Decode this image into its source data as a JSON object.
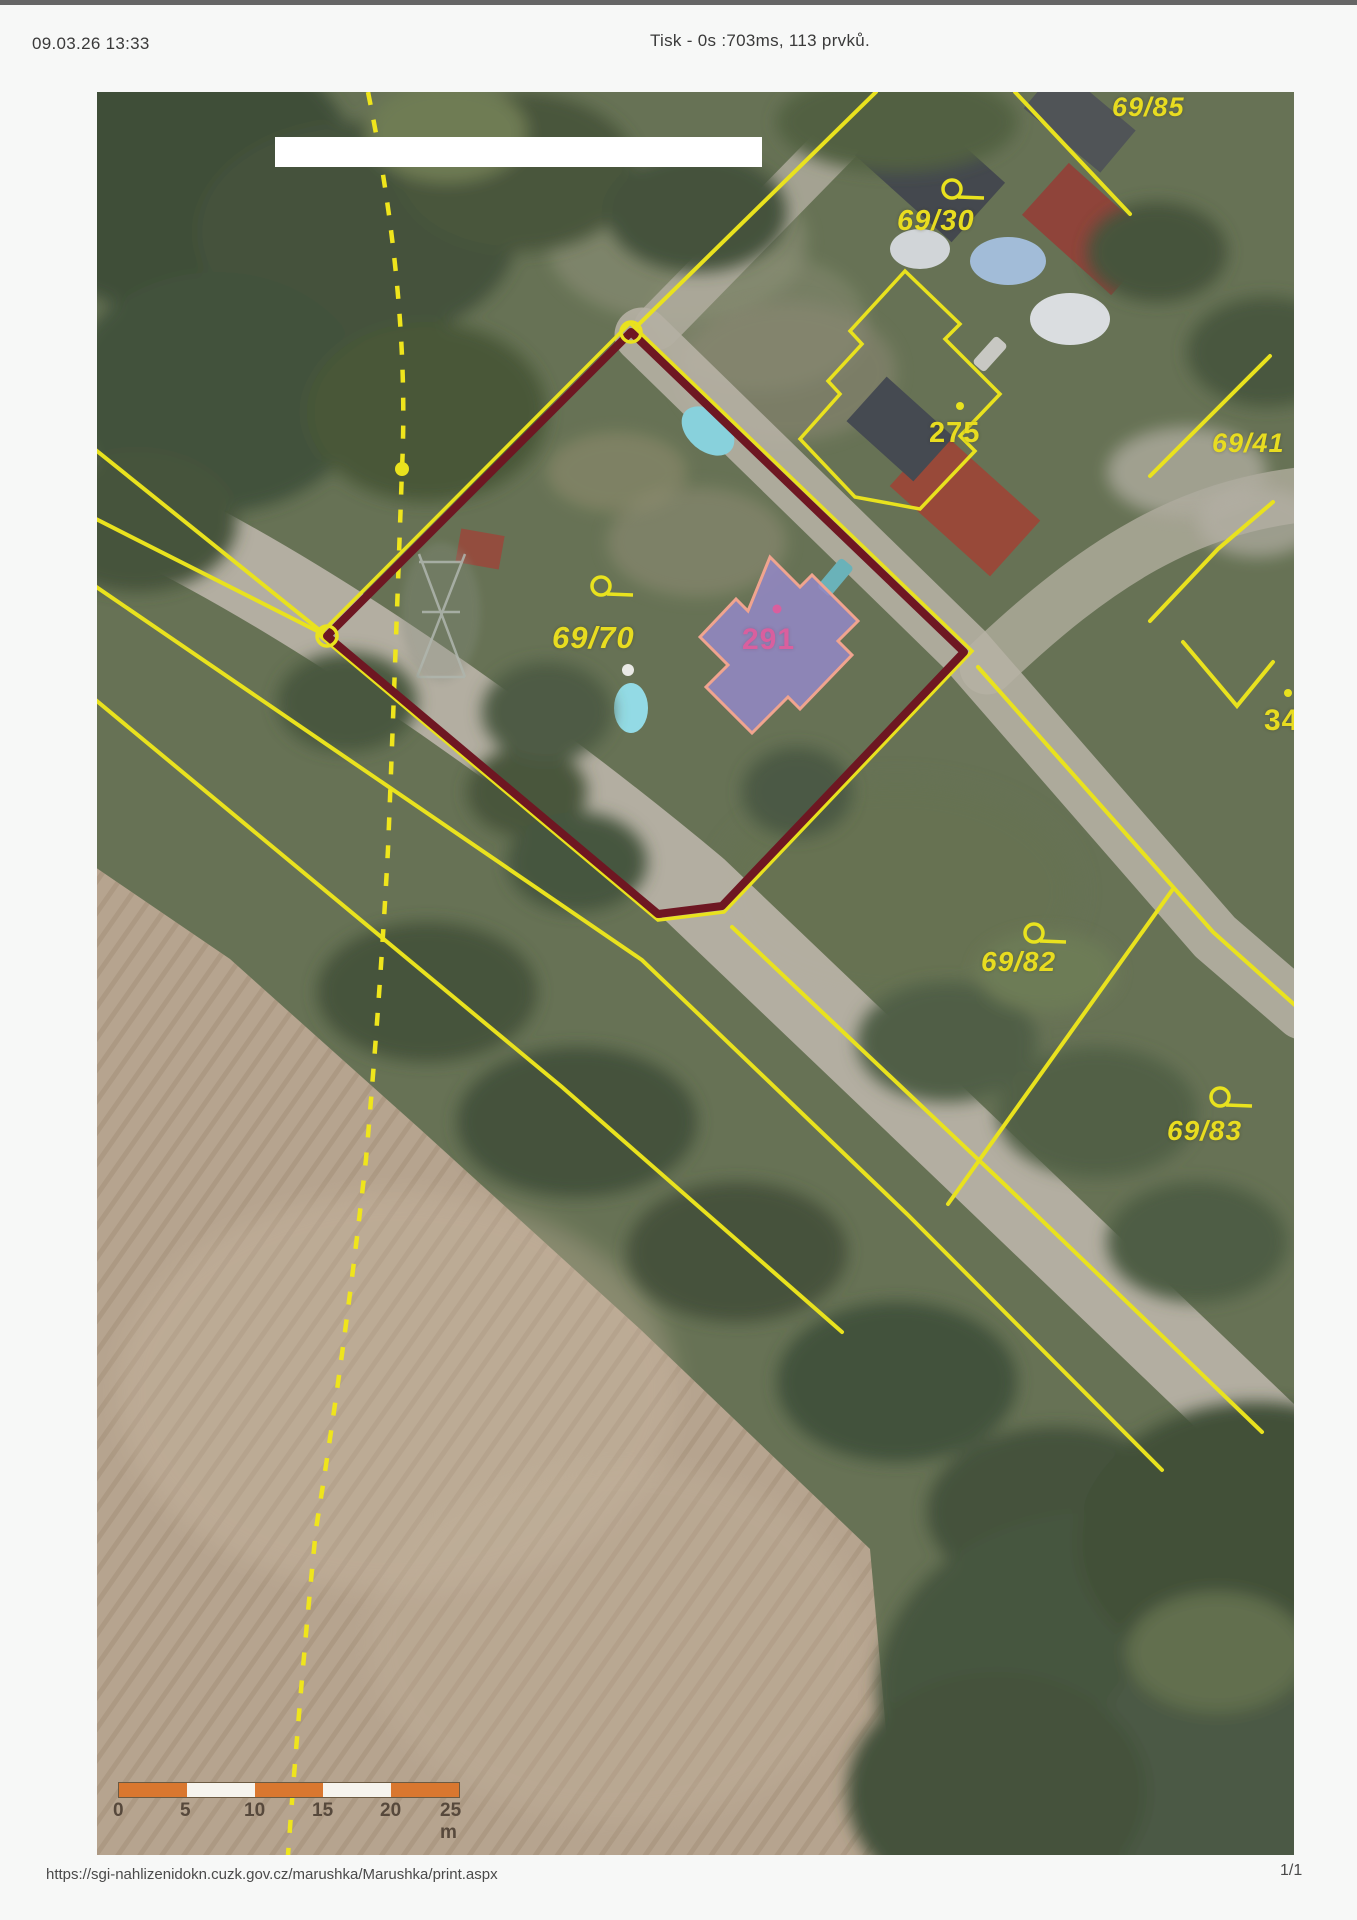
{
  "header": {
    "datetime": "09.03.26 13:33",
    "print_status": "Tisk - 0s :703ms, 113 prvků."
  },
  "footer": {
    "url": "https://sgi-nahlizenidokn.cuzk.gov.cz/marushka/Marushka/print.aspx",
    "page_indicator": "1/1"
  },
  "map": {
    "parcel_labels": [
      {
        "id": "69/85",
        "text": "69/85"
      },
      {
        "id": "69/30",
        "text": "69/30"
      },
      {
        "id": "69/41",
        "text": "69/41"
      },
      {
        "id": "69/70",
        "text": "69/70"
      },
      {
        "id": "69/82",
        "text": "69/82"
      },
      {
        "id": "69/83",
        "text": "69/83"
      }
    ],
    "building_labels": [
      {
        "id": "275",
        "text": "275"
      },
      {
        "id": "34",
        "text": "34"
      },
      {
        "id": "291",
        "text": "291"
      }
    ],
    "icons": {
      "parcel_point_marker": "circle-with-tail",
      "vertex_marker": "ring",
      "boundary_point": "dot"
    },
    "colors": {
      "cadastre_line_yellow": "#e9e21e",
      "selected_parcel_red": "#6e1722",
      "building_fill_purple": "#9387c4",
      "building_outline_pink": "#f0a48f",
      "building_label_pink": "#d95f9e",
      "scalebar_orange": "#d9772f"
    },
    "scale_bar": {
      "ticks": [
        "0",
        "5",
        "10",
        "15",
        "20",
        "25 m"
      ]
    }
  }
}
